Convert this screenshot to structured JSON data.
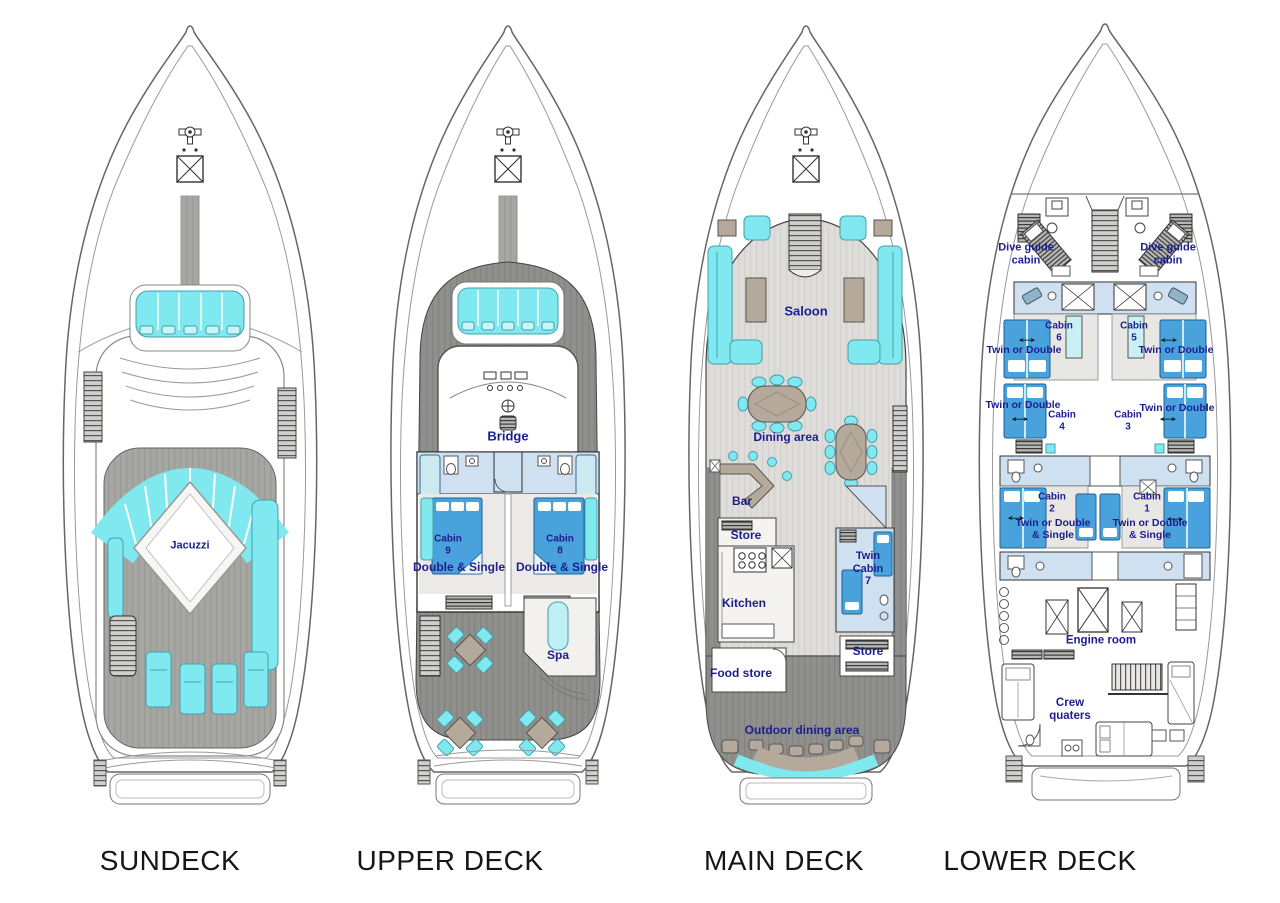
{
  "diagram": {
    "type": "yacht-deck-plans",
    "decks": {
      "sundeck": {
        "title": "SUNDECK",
        "labels": {
          "jacuzzi": "Jacuzzi"
        }
      },
      "upper": {
        "title": "UPPER DECK",
        "labels": {
          "bridge": "Bridge",
          "cabin9_name": "Cabin\n9",
          "cabin9_type": "Double & Single",
          "cabin8_name": "Cabin\n8",
          "cabin8_type": "Double & Single",
          "spa": "Spa"
        }
      },
      "main": {
        "title": "MAIN DECK",
        "labels": {
          "saloon": "Saloon",
          "dining_area": "Dining area",
          "bar": "Bar",
          "store_fwd": "Store",
          "kitchen": "Kitchen",
          "food_store": "Food store",
          "cabin7": "Twin\nCabin\n7",
          "store_aft": "Store",
          "outdoor_dining": "Outdoor dining area"
        }
      },
      "lower": {
        "title": "LOWER DECK",
        "labels": {
          "dive_guide_port": "Dive guide\ncabin",
          "dive_guide_stbd": "Dive guide\ncabin",
          "cabin6_name": "Cabin\n6",
          "cabin6_type": "Twin or Double",
          "cabin5_name": "Cabin\n5",
          "cabin5_type": "Twin or Double",
          "cabin4_name": "Cabin\n4",
          "cabin4_type": "Twin or Double",
          "cabin3_name": "Cabin\n3",
          "cabin3_type": "Twin or Double",
          "cabin2_name": "Cabin\n2",
          "cabin2_type": "Twin or Double\n& Single",
          "cabin1_name": "Cabin\n1",
          "cabin1_type": "Twin or Double\n& Single",
          "engine_room": "Engine room",
          "crew_quarters": "Crew\nquaters"
        }
      }
    },
    "icons": {
      "double_arrow": "↔"
    },
    "colors": {
      "furniture_cyan": "#7fe9ef",
      "bed_blue": "#4aa2dc",
      "bathroom_blue": "#cfe0f1",
      "table_tan": "#b5a99c",
      "deck_gray": "#a6a6a3",
      "deck_dark_gray": "#8f8f8c",
      "label_navy": "#1d1d8f",
      "title_black": "#161616"
    }
  }
}
